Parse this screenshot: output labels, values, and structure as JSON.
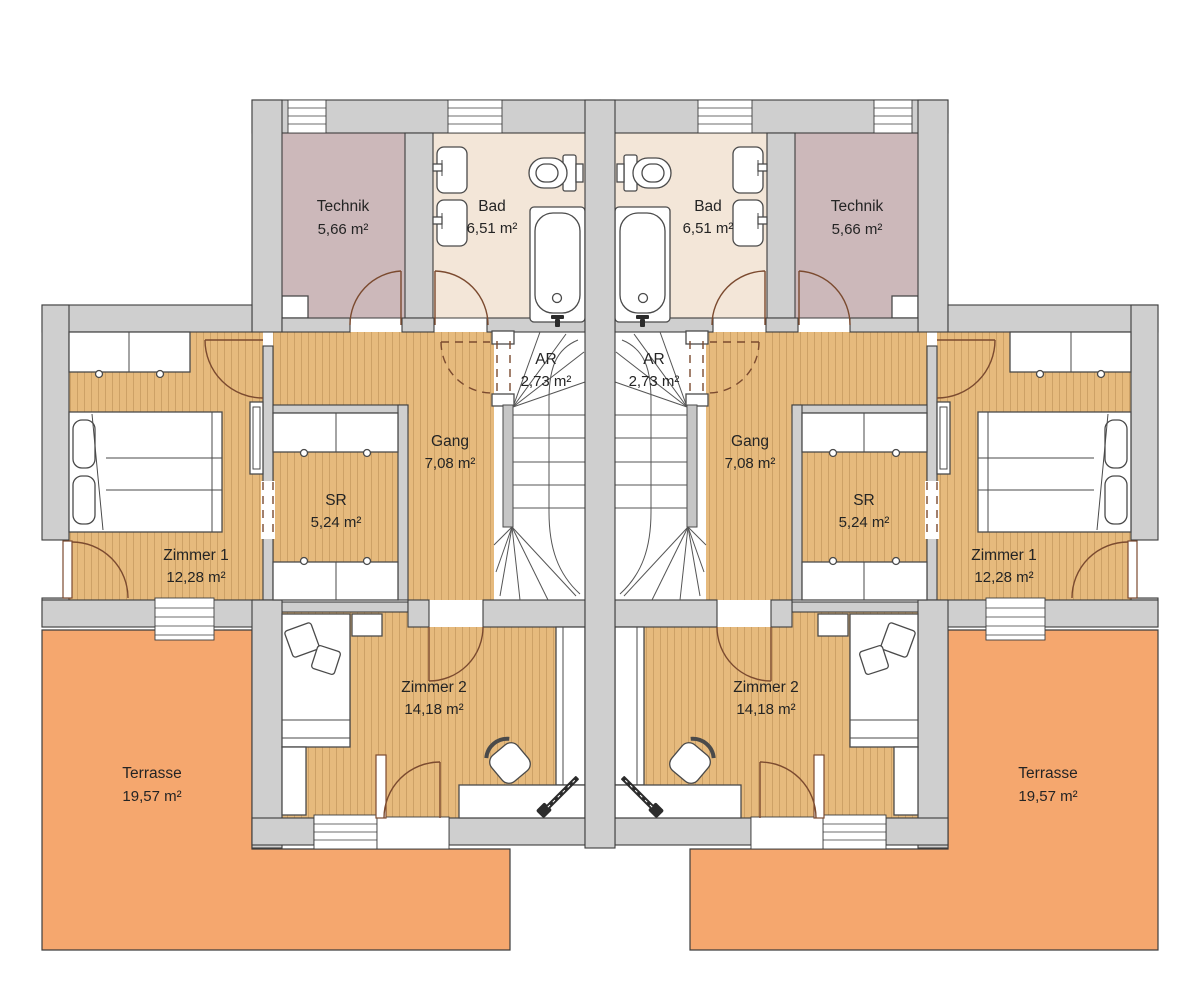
{
  "plan": {
    "kind": "residential floor plan, two mirrored duplex units",
    "language": "German"
  },
  "rooms": {
    "technik": {
      "name": "Technik",
      "area": "5,66 m²"
    },
    "bad": {
      "name": "Bad",
      "area": "6,51 m²"
    },
    "ar": {
      "name": "AR",
      "area": "2,73 m²"
    },
    "gang": {
      "name": "Gang",
      "area": "7,08 m²"
    },
    "sr": {
      "name": "SR",
      "area": "5,24 m²"
    },
    "zimmer1": {
      "name": "Zimmer 1",
      "area": "12,28 m²"
    },
    "zimmer2": {
      "name": "Zimmer 2",
      "area": "14,18 m²"
    },
    "terrasse": {
      "name": "Terrasse",
      "area": "19,57 m²"
    }
  },
  "colors": {
    "wall": "#cfcfcf",
    "outline": "#3d3d3d",
    "wood": "#e6ba7d",
    "technik": "#ccb8ba",
    "bad": "#f3e6d8",
    "terrasse": "#f5a76e",
    "door": "#7b4a2f",
    "label": "#242424"
  }
}
